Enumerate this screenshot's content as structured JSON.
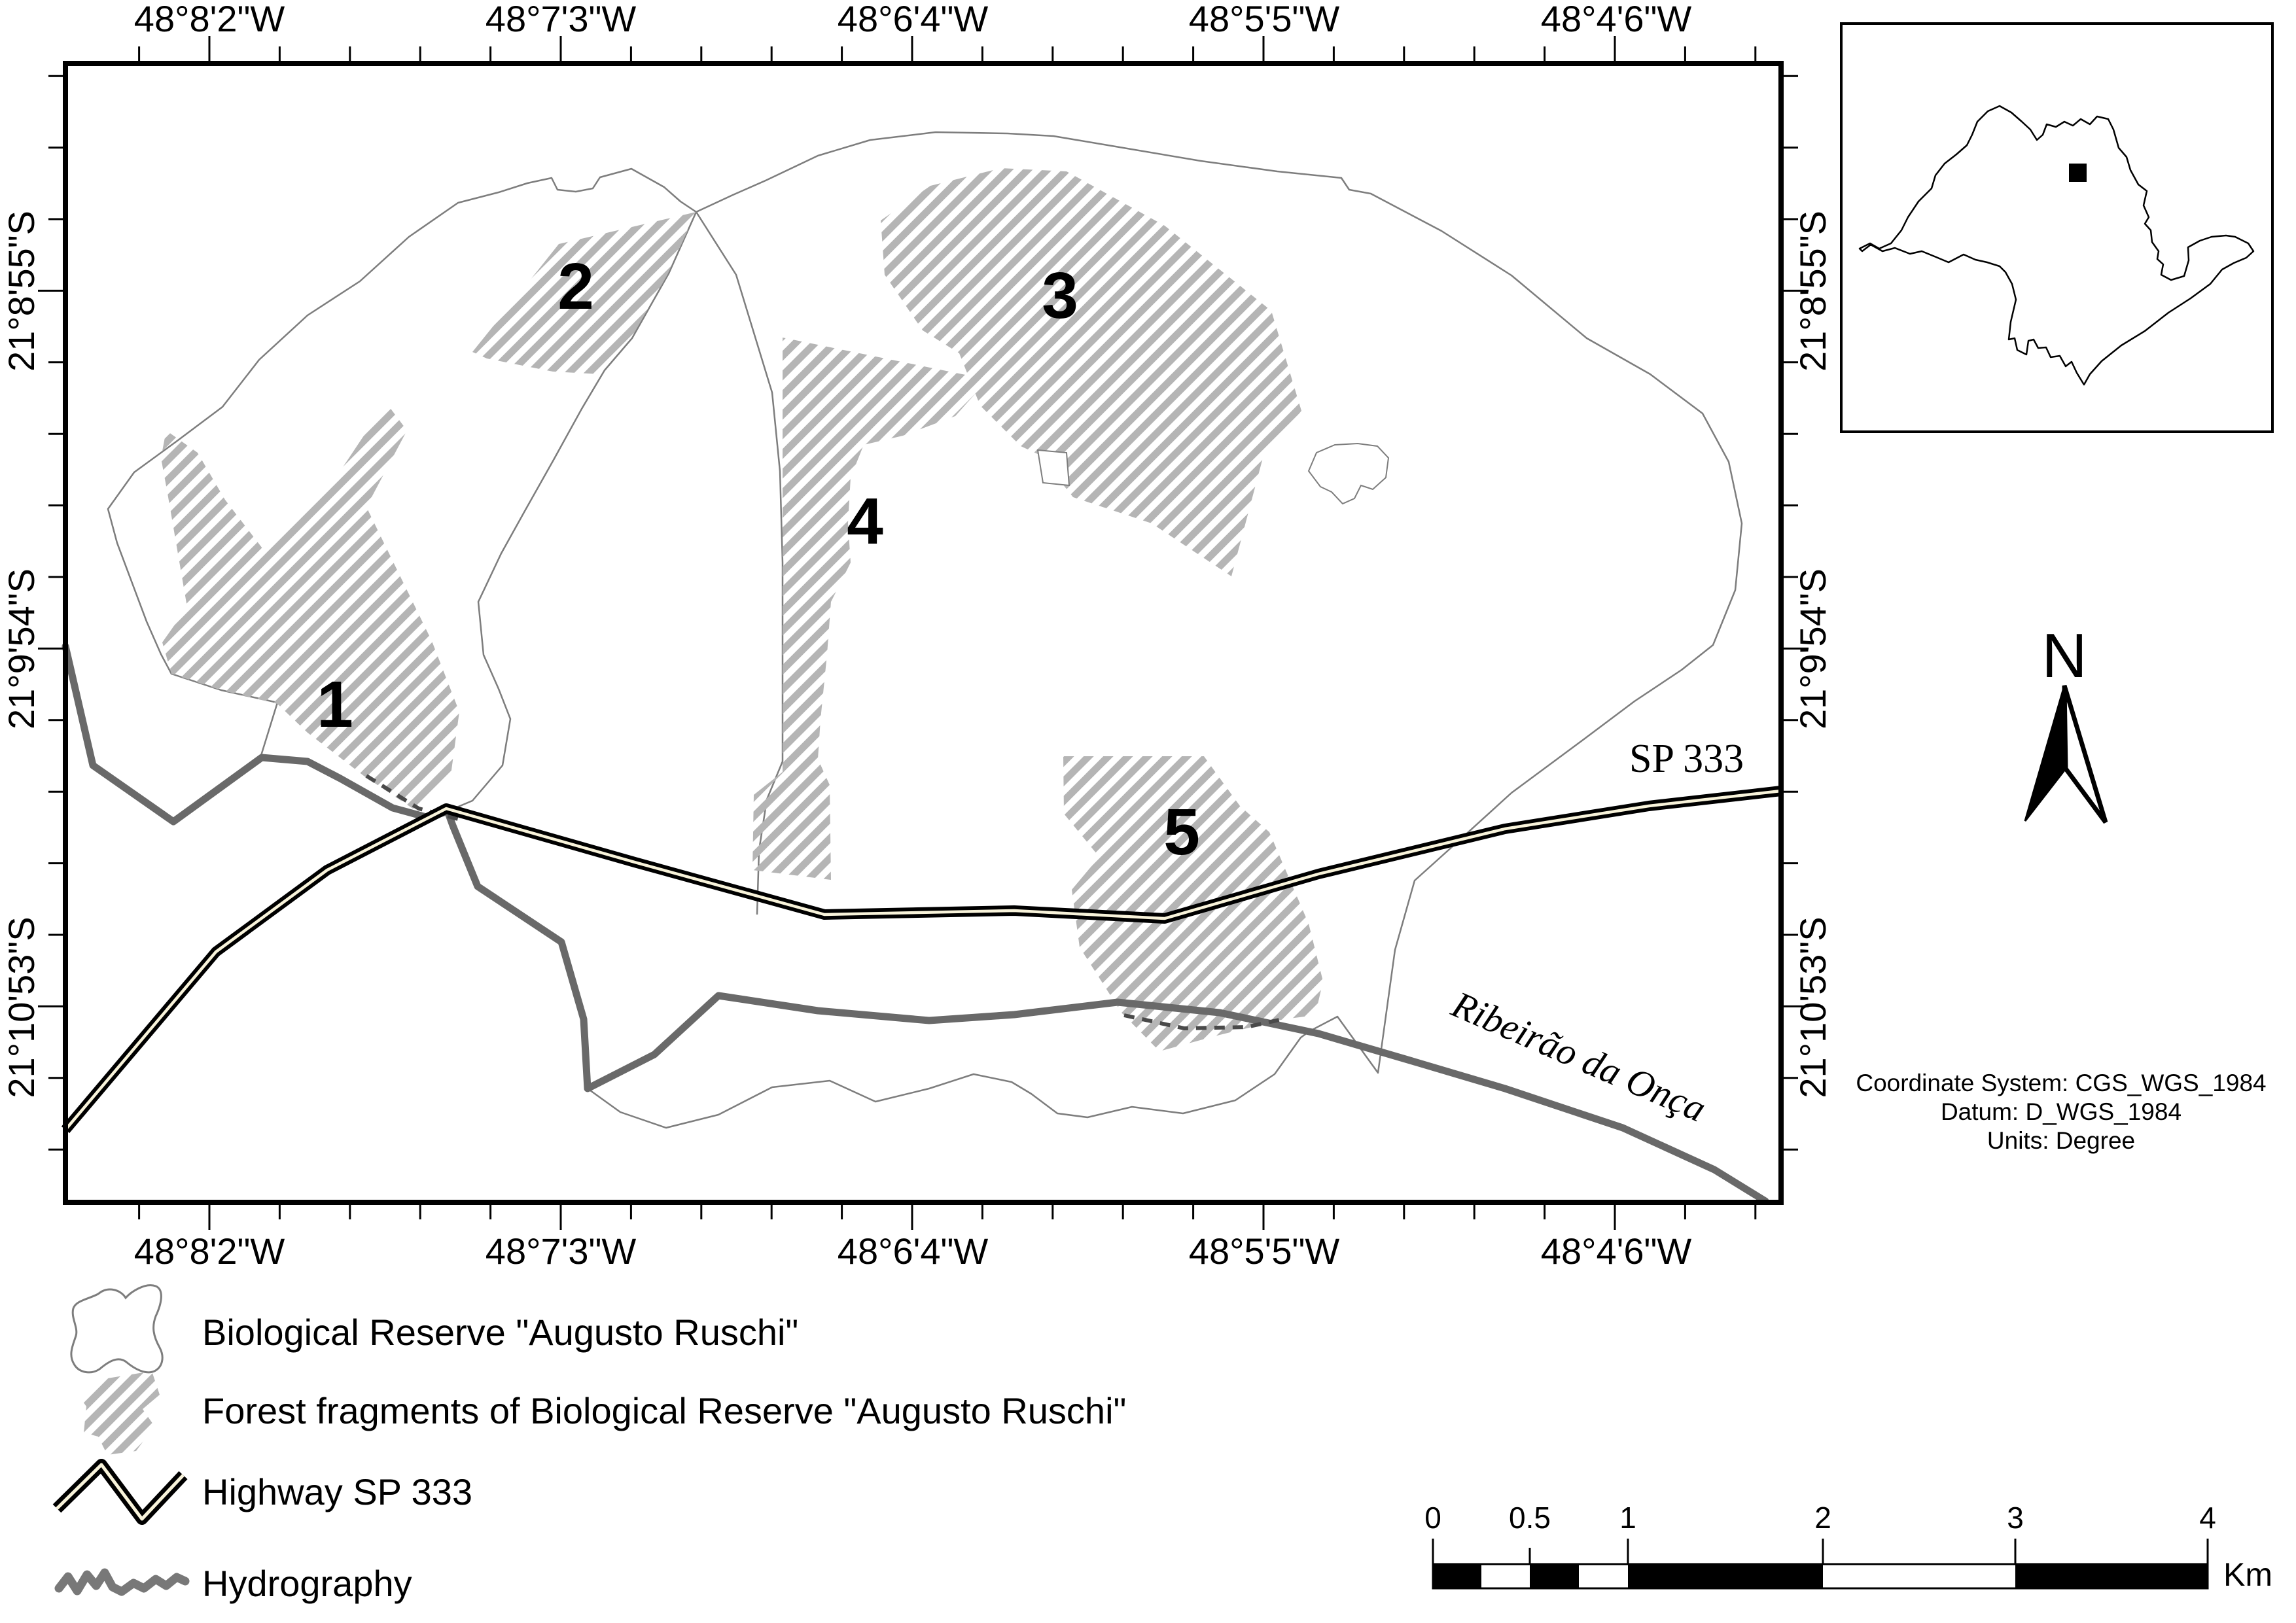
{
  "map_frame": {
    "axis_labels": {
      "top": [
        "48°8'2\"W",
        "48°7'3\"W",
        "48°6'4\"W",
        "48°5'5\"W",
        "48°4'6\"W"
      ],
      "bottom": [
        "48°8'2\"W",
        "48°7'3\"W",
        "48°6'4\"W",
        "48°5'5\"W",
        "48°4'6\"W"
      ],
      "left": [
        "21°8'55\"S",
        "21°9'54\"S",
        "21°10'53\"S"
      ],
      "right": [
        "21°8'55\"S",
        "21°9'54\"S",
        "21°10'53\"S"
      ]
    },
    "fragment_labels": [
      "1",
      "2",
      "3",
      "4",
      "5"
    ],
    "road_label": "SP 333",
    "river_label": "Ribeirão da Onça"
  },
  "north_arrow": {
    "label": "N"
  },
  "credits": {
    "line1": "Coordinate System: CGS_WGS_1984",
    "line2": "Datum: D_WGS_1984",
    "line3": "Units: Degree"
  },
  "legend": {
    "items": [
      {
        "symbol": "reserve-outline",
        "label": "Biological Reserve \"Augusto Ruschi\""
      },
      {
        "symbol": "hatched-patch",
        "label": "Forest fragments of Biological Reserve \"Augusto Ruschi\""
      },
      {
        "symbol": "highway-zigzag",
        "label": "Highway SP 333"
      },
      {
        "symbol": "river-squiggle",
        "label": "Hydrography"
      }
    ]
  },
  "scale_bar": {
    "tick_labels": [
      "0",
      "0.5",
      "1",
      "2",
      "3",
      "4"
    ],
    "unit": "Km"
  },
  "colors": {
    "hatch": "#b5b5b5",
    "boundary": "#7d7d7d",
    "river": "#696969",
    "road_casing": "#000000",
    "road_center": "#f8f3da"
  }
}
